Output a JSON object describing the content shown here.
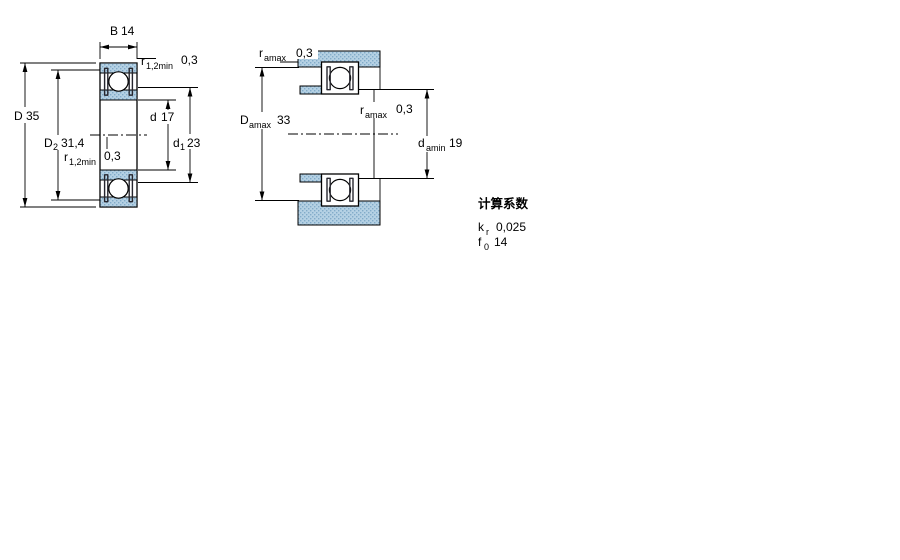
{
  "colors": {
    "section_fill": "#b5d1e4",
    "section_dot": "#82abc9",
    "line": "#000000",
    "seal": "#26262e",
    "background": "#ffffff"
  },
  "left_diagram": {
    "name": "bearing cross-section with boundary dimensions",
    "dims": {
      "B": {
        "label": "B",
        "value": "14"
      },
      "D": {
        "label": "D",
        "value": "35"
      },
      "D2": {
        "label": "D",
        "sub": "2",
        "value": "31,4"
      },
      "d": {
        "label": "d",
        "value": "17"
      },
      "d1": {
        "label": "d",
        "sub": "1",
        "value": "23"
      },
      "r_top": {
        "label": "r",
        "sub": "1,2min",
        "value": "0,3"
      },
      "r_bottom": {
        "label": "r",
        "sub": "1,2min",
        "value": "0,3"
      }
    }
  },
  "right_diagram": {
    "name": "mounting abutment and fillet dimensions",
    "dims": {
      "ra_top": {
        "label": "r",
        "sub": "amax",
        "value": "0,3"
      },
      "Da": {
        "label": "D",
        "sub": "amax",
        "value": "33"
      },
      "ra_mid": {
        "label": "r",
        "sub": "amax",
        "value": "0,3"
      },
      "da": {
        "label": "d",
        "sub": "amin",
        "value": "19"
      }
    }
  },
  "calculation_factors": {
    "title": "计算系数",
    "rows": [
      {
        "label": "k",
        "sub": "r",
        "value": "0,025"
      },
      {
        "label": "f",
        "sub": "0",
        "value": "14"
      }
    ]
  }
}
